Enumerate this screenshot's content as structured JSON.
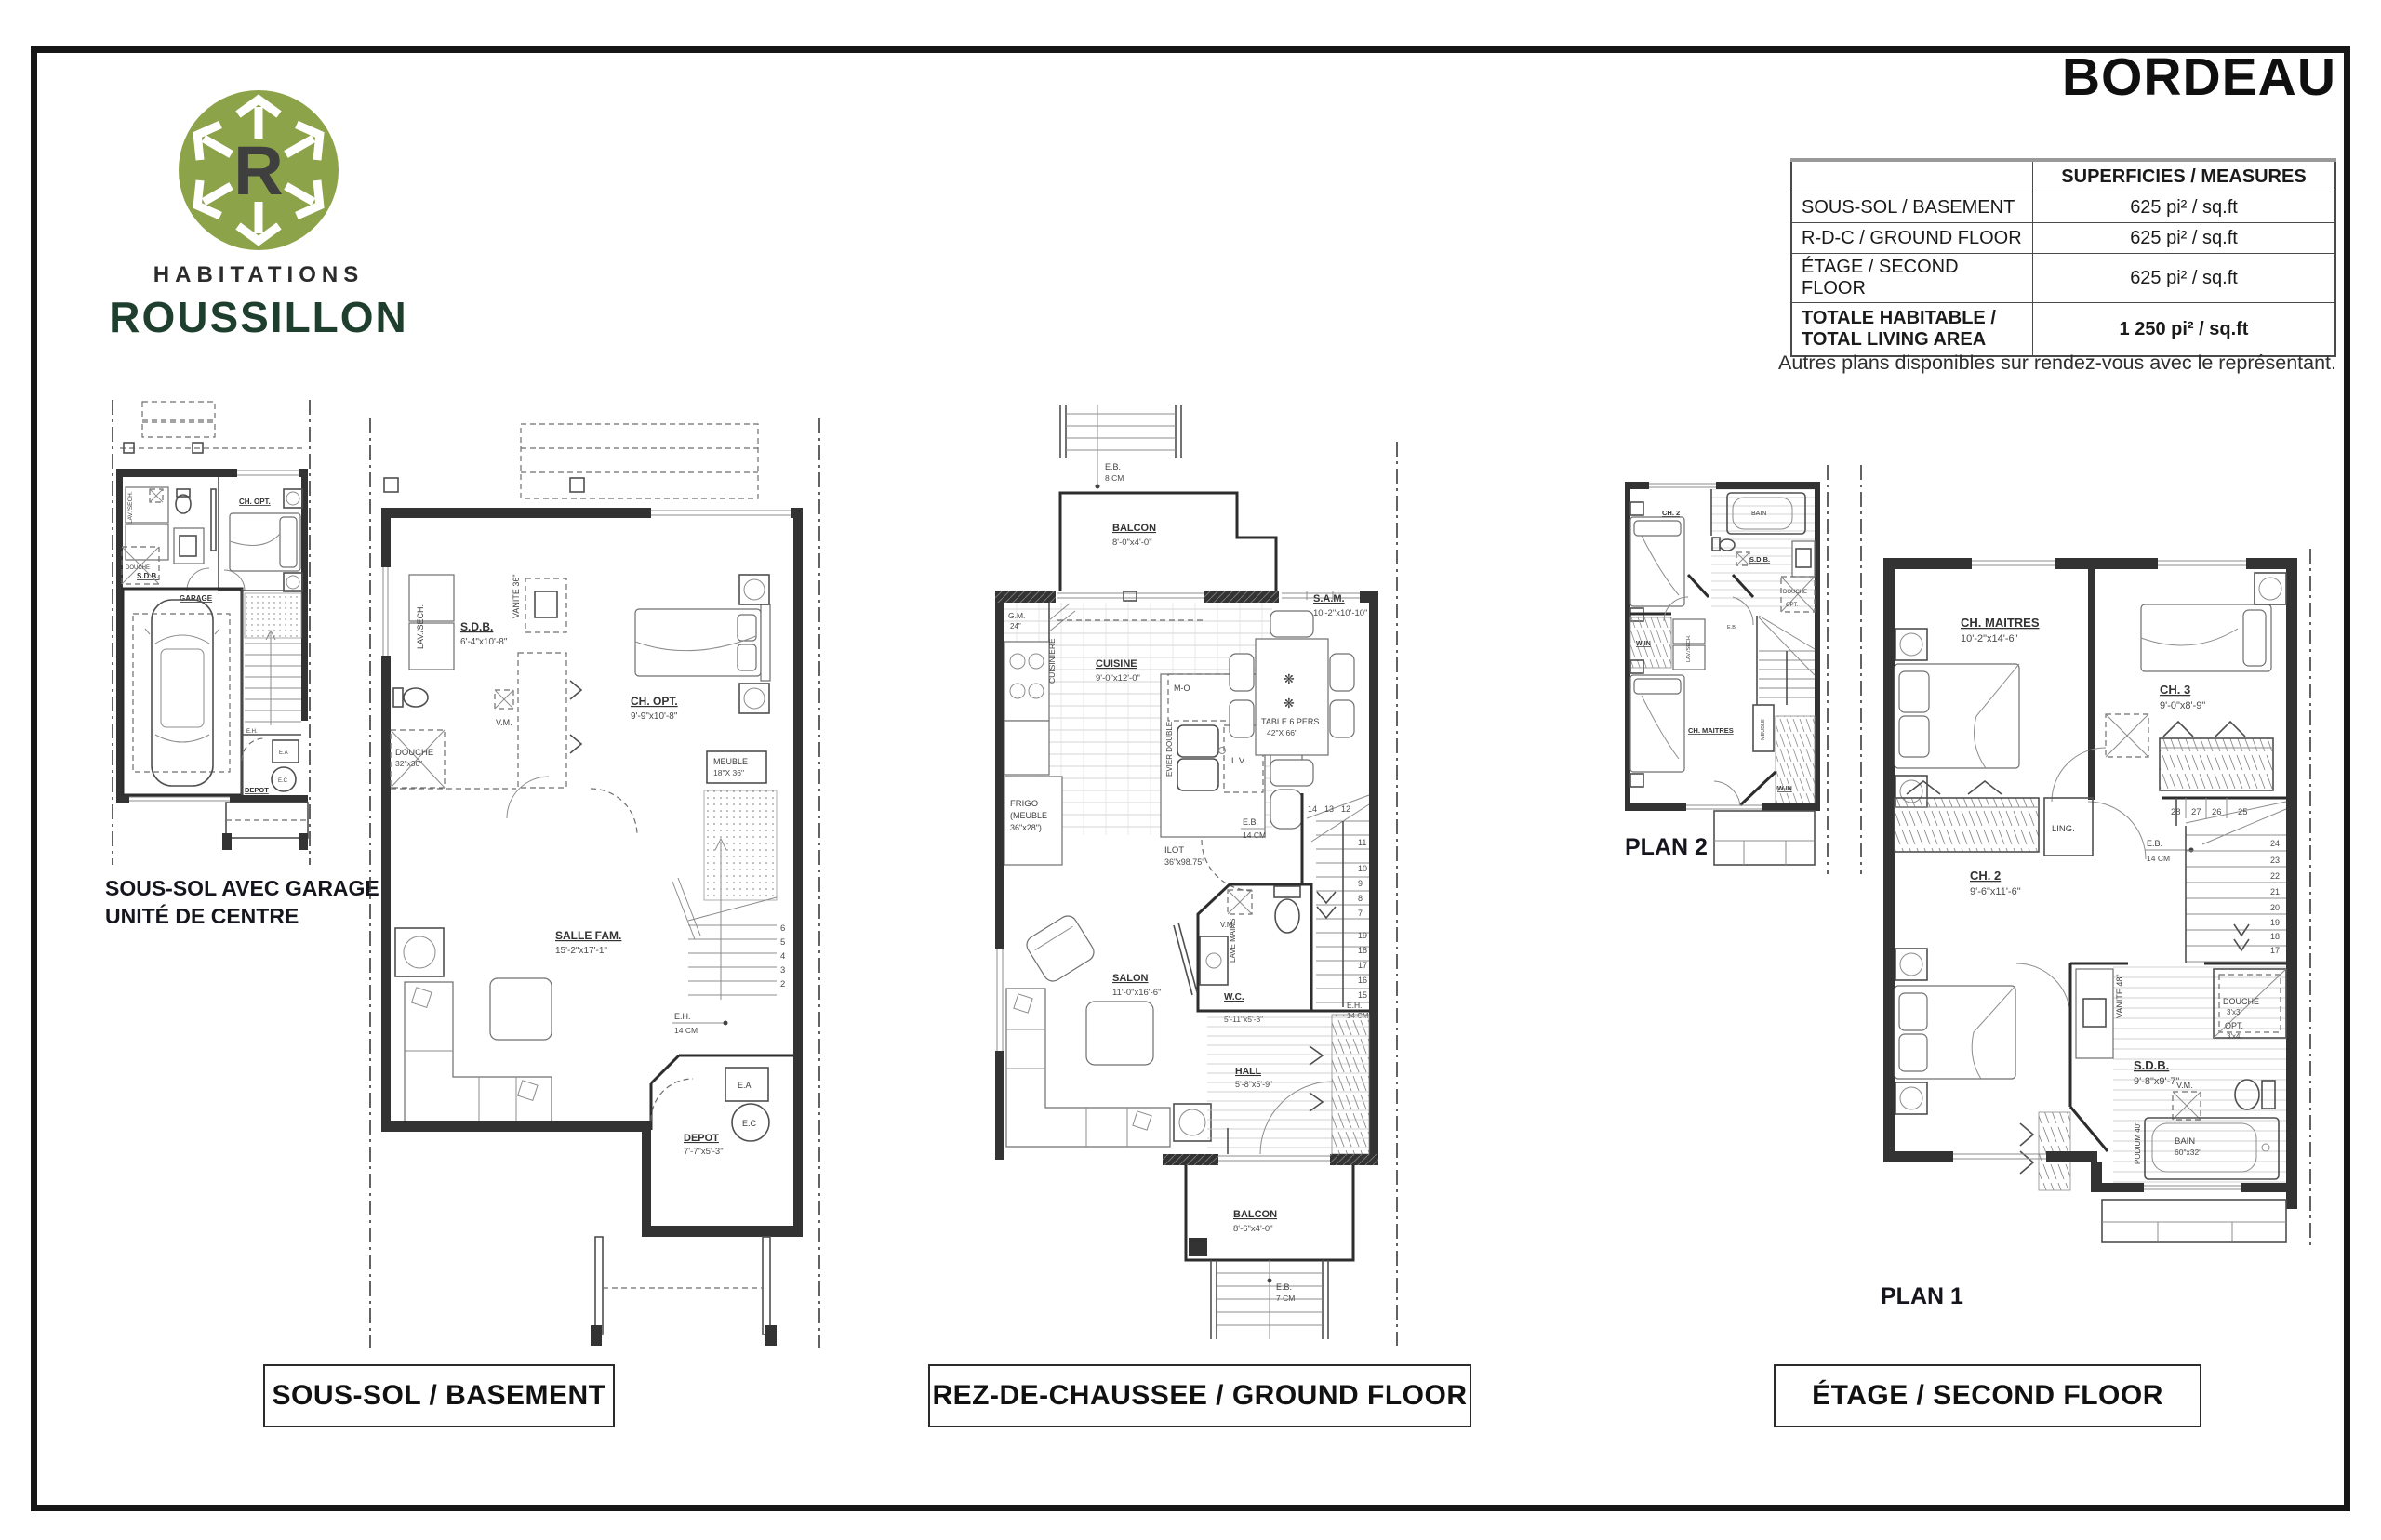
{
  "page": {
    "title": "BORDEAU",
    "note": "Autres plans disponibles sur rendez-vous avec le représentant."
  },
  "logo": {
    "letter": "R",
    "line1": "HABITATIONS",
    "line2": "ROUSSILLON",
    "green": "#8DA349",
    "dark_green": "#1F3F2E"
  },
  "measures": {
    "header": "SUPERFICIES / MEASURES",
    "rows": [
      {
        "label": "SOUS-SOL / BASEMENT",
        "value": "625 pi² / sq.ft"
      },
      {
        "label": "R-D-C / GROUND FLOOR",
        "value": "625 pi² / sq.ft"
      },
      {
        "label": "ÉTAGE / SECOND FLOOR",
        "value": "625 pi² / sq.ft"
      }
    ],
    "total_label1": "TOTALE HABITABLE /",
    "total_label2": "TOTAL LIVING AREA",
    "total_value": "1 250 pi² / sq.ft"
  },
  "captions": {
    "basement": "SOUS-SOL / BASEMENT",
    "ground": "REZ-DE-CHAUSSEE / GROUND FLOOR",
    "second": "ÉTAGE / SECOND FLOOR"
  },
  "bsmall": {
    "caption1": "SOUS-SOL AVEC GARAGE",
    "caption2": "UNITÉ DE CENTRE",
    "lav_sech": "LAV./SECH.",
    "sdb": "S.D.B.",
    "douche": "DOUCHE",
    "ch_opt": "CH. OPT.",
    "garage": "GARAGE",
    "eh": "E.H.",
    "depot": "DEPOT",
    "ea": "E.A",
    "ec": "E.C"
  },
  "bmain": {
    "sdb": {
      "n": "S.D.B.",
      "d": "6'-4\"x10'-8\""
    },
    "vanite": "VANITE 36\"",
    "lav_sech": "LAV./SECH.",
    "vm": "V.M.",
    "douche": {
      "n": "DOUCHE",
      "d": "32\"x30\""
    },
    "ch_opt": {
      "n": "CH. OPT.",
      "d": "9'-9\"x10'-8\""
    },
    "meuble": {
      "n": "MEUBLE",
      "d": "18\"X 36\""
    },
    "salle_fam": {
      "n": "SALLE FAM.",
      "d": "15'-2\"x17'-1\""
    },
    "eh": {
      "n": "E.H.",
      "d": "14 CM"
    },
    "depot": {
      "n": "DEPOT",
      "d": "7'-7\"x5'-3\""
    },
    "ea": "E.A",
    "ec": "E.C",
    "stairs": [
      "6",
      "5",
      "4",
      "3",
      "2"
    ]
  },
  "ground": {
    "eb_top": {
      "n": "E.B.",
      "d": "8 CM"
    },
    "balcon_top": {
      "n": "BALCON",
      "d": "8'-0\"x4'-0\""
    },
    "gm": {
      "n": "G.M.",
      "d": "24\""
    },
    "cuisine": {
      "n": "CUISINE",
      "d": "9'-0\"x12'-0\""
    },
    "sam": {
      "n": "S.A.M.",
      "d": "10'-2\"x10'-10\""
    },
    "cuisiniere": "CUISINIERE",
    "mo": "M-O",
    "evier": "EVIER DOUBLE",
    "frigo1": "FRIGO",
    "frigo2": "(MEUBLE",
    "frigo3": "36\"x28\")",
    "lv": "L.V.",
    "ilot": {
      "n": "ILOT",
      "d": "36\"x98.75\""
    },
    "table1": "TABLE 6 PERS.",
    "table2": "42\"X 66\"",
    "eb_mid": {
      "n": "E.B.",
      "d": "14 CM"
    },
    "salon": {
      "n": "SALON",
      "d": "11'-0\"x16'-6\""
    },
    "vm": "V.M.",
    "lave_mains": "LAVE MAINS",
    "wc": {
      "n": "W.C.",
      "d": "5'-11\"x5'-3\""
    },
    "eh": {
      "n": "E.H.",
      "d": "14 CM"
    },
    "hall": {
      "n": "HALL",
      "d": "5'-8\"x5'-9\""
    },
    "balcon_bot": {
      "n": "BALCON",
      "d": "8'-6\"x4'-0\""
    },
    "eb_bot": {
      "n": "E.B.",
      "d": "7 CM"
    },
    "stairs_top": [
      "14",
      "13",
      "12"
    ],
    "stairs_mid": [
      "11",
      "10",
      "9",
      "8",
      "7"
    ],
    "stairs_low": [
      "19",
      "18",
      "17",
      "16",
      "15"
    ]
  },
  "plan2": {
    "label": "PLAN 2",
    "ch2": "CH. 2",
    "bain": "BAIN",
    "sdb": "S.D.B.",
    "douche": "DOUCHE",
    "opt": "OPT.",
    "win": "W-IN",
    "lav_sech": "LAV./SECH.",
    "eb": "E.B.",
    "ch_maitres": "CH. MAITRES",
    "meuble": "MEUBLE",
    "win2": "W-IN"
  },
  "plan1": {
    "label": "PLAN 1",
    "ch_maitres": {
      "n": "CH. MAITRES",
      "d": "10'-2\"x14'-6\""
    },
    "ch3": {
      "n": "CH. 3",
      "d": "9'-0\"x8'-9\""
    },
    "ling": "LING.",
    "ch2": {
      "n": "CH. 2",
      "d": "9'-6\"x11'-6\""
    },
    "vanite": "VANITE 48\"",
    "douche": {
      "n": "DOUCHE",
      "d": "3'x3'"
    },
    "opt": {
      "n": "OPT.",
      "d": "3'x4'"
    },
    "sdb": {
      "n": "S.D.B.",
      "d": "9'-8\"x9'-7\""
    },
    "vm": "V.M.",
    "bain1": "BAIN",
    "bain2": "60\"x32\"",
    "podium": "PODIUM 40\"",
    "eb": {
      "n": "E.B.",
      "d": "14 CM"
    },
    "stairs_top": [
      "28",
      "27",
      "26",
      "25"
    ],
    "stairs_side": [
      "24",
      "23",
      "22",
      "21",
      "20",
      "19",
      "18",
      "17"
    ]
  }
}
